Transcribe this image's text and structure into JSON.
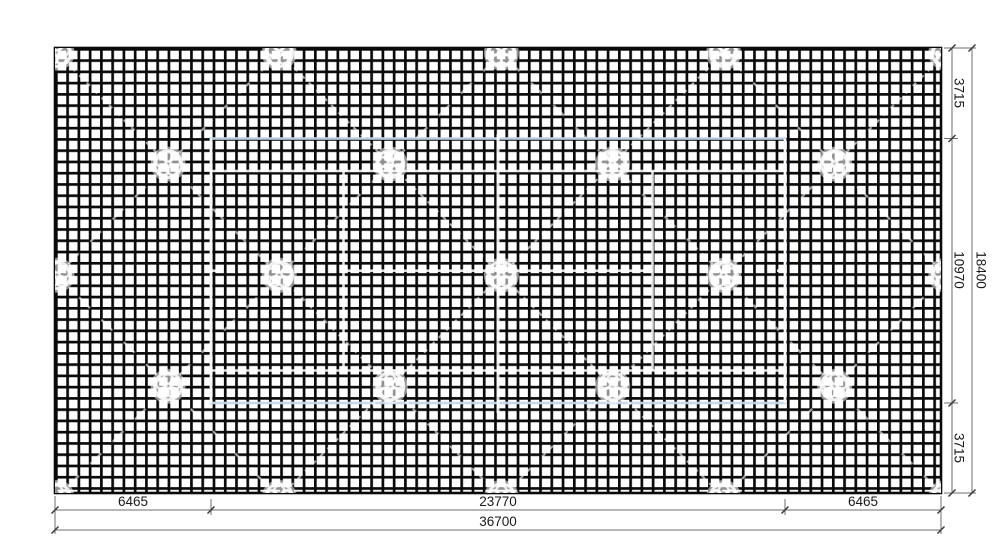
{
  "drawing": {
    "bottom_dims": {
      "left": "6465",
      "middle": "23770",
      "right": "6465",
      "total": "36700"
    },
    "right_dims": {
      "top": "3715",
      "middle": "10970",
      "bottom": "3715",
      "total": "18400"
    }
  },
  "colors": {
    "mesh_black": "#0a0a0a",
    "court_edge_blue": "#c6d7ea",
    "court_line_white": "#ffffff",
    "dim_line_gray": "#6e6e6e",
    "label_dark": "#1a1a1a",
    "watermark_gray": "#cfcfcf"
  }
}
